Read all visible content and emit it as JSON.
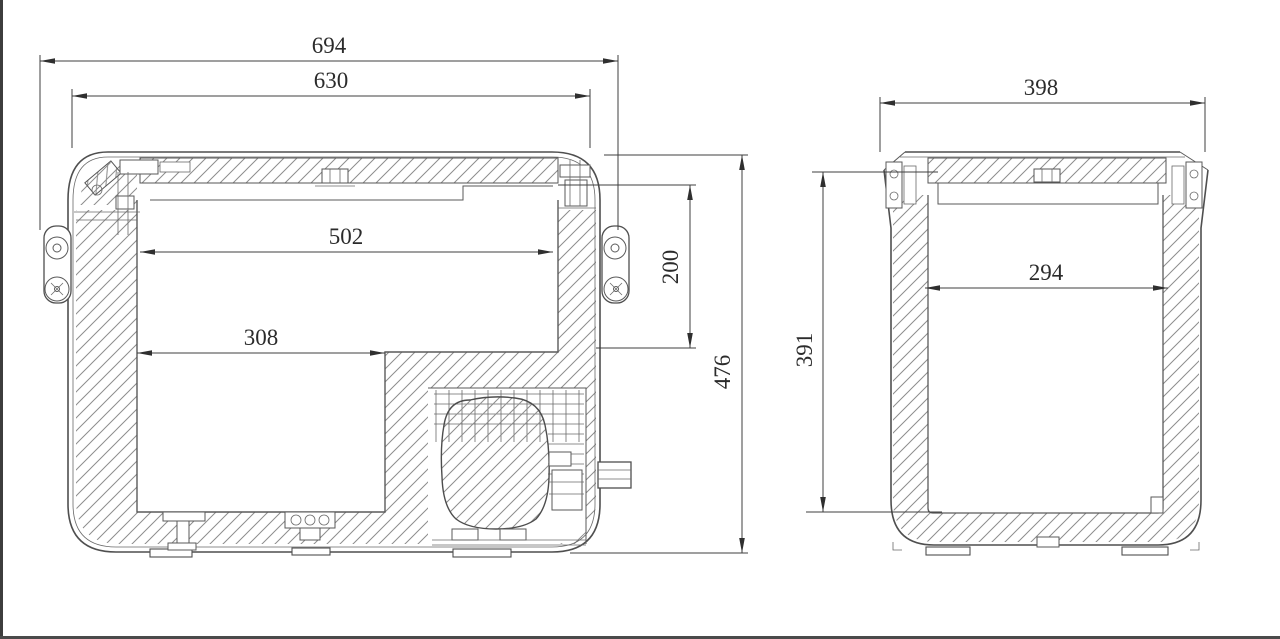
{
  "page": {
    "background": "#ffffff",
    "frame_color": "#3d3d3d"
  },
  "drawing": {
    "type": "technical-cross-section",
    "subject": "portable cooler box sectional views with dimensions",
    "line_color": "#4f4f4f",
    "hatch_color": "#8a8a8a",
    "views": {
      "front": {
        "name": "front-section",
        "dimensions": {
          "overall_width": "694",
          "lid_width": "630",
          "inner_width_upper": "502",
          "inner_width_lower": "308",
          "compartment_depth": "200",
          "overall_height": "476"
        }
      },
      "side": {
        "name": "side-section",
        "dimensions": {
          "overall_width": "398",
          "inner_width": "294",
          "inner_depth": "391"
        }
      }
    }
  }
}
